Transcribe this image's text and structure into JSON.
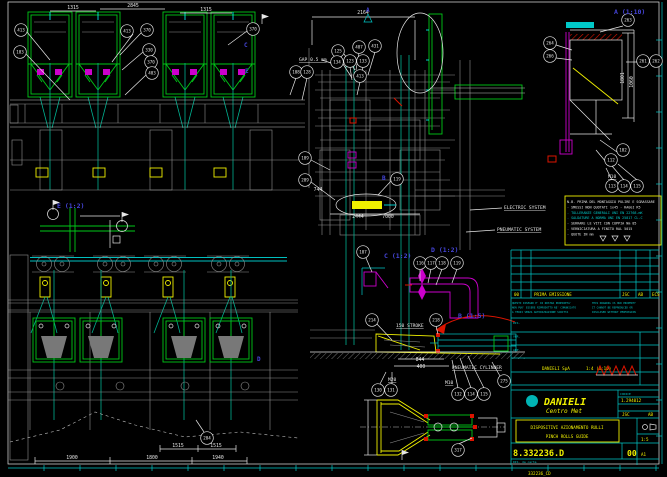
{
  "sheet": {
    "background": "#000000",
    "border_color": "#e6e6e6",
    "tick_color": "#00c8c8",
    "accent_green": "#00c818",
    "accent_cyan": "#00c8c8",
    "accent_magenta": "#cc00cc",
    "accent_yellow": "#f0f000",
    "accent_red": "#dc1400",
    "label_blue": "#4646dc"
  },
  "view_labels": [
    {
      "t": "A  (1:10)",
      "x": 614,
      "y": 14
    },
    {
      "t": "E  (1:2)",
      "x": 57,
      "y": 208
    },
    {
      "t": "C  (1:2)",
      "x": 384,
      "y": 258
    },
    {
      "t": "D  (1:2)",
      "x": 431,
      "y": 252
    },
    {
      "t": "B  (1:5)",
      "x": 458,
      "y": 318
    }
  ],
  "section_letters": [
    {
      "t": "A",
      "x": 366,
      "y": 12
    },
    {
      "t": "C",
      "x": 244,
      "y": 47
    },
    {
      "t": "E",
      "x": 245,
      "y": 73
    },
    {
      "t": "B",
      "x": 382,
      "y": 180
    },
    {
      "t": "D",
      "x": 257,
      "y": 361
    }
  ],
  "texts": [
    {
      "t": "GAP 0.5 mm",
      "x": 299,
      "y": 61,
      "u": true
    },
    {
      "t": "ELECTRIC SYSTEM",
      "x": 504,
      "y": 209,
      "u": true
    },
    {
      "t": "PNEUMATIC SYSTEM",
      "x": 497,
      "y": 231,
      "u": true
    },
    {
      "t": "PNEUMATIC CYLINDER",
      "x": 452,
      "y": 369,
      "u": true
    },
    {
      "t": "150 STROKE",
      "x": 396,
      "y": 327,
      "u": true
    },
    {
      "t": "M20",
      "x": 388,
      "y": 381,
      "u": true
    },
    {
      "t": "M10",
      "x": 445,
      "y": 384,
      "u": true
    },
    {
      "t": "M10",
      "x": 608,
      "y": 178,
      "u": true
    }
  ],
  "dims": [
    {
      "t": "1315",
      "x": 73,
      "y": 9
    },
    {
      "t": "2845",
      "x": 133,
      "y": 7
    },
    {
      "t": "1315",
      "x": 206,
      "y": 11
    },
    {
      "t": "2164",
      "x": 363,
      "y": 14
    },
    {
      "t": "1801",
      "x": 624,
      "y": 78,
      "r": -90
    },
    {
      "t": "1060",
      "x": 633,
      "y": 82,
      "r": -90
    },
    {
      "t": "744",
      "x": 318,
      "y": 191
    },
    {
      "t": "2444",
      "x": 358,
      "y": 218
    },
    {
      "t": "7000",
      "x": 388,
      "y": 218
    },
    {
      "t": "844",
      "x": 420,
      "y": 361
    },
    {
      "t": "400",
      "x": 421,
      "y": 368
    },
    {
      "t": "1515",
      "x": 178,
      "y": 447
    },
    {
      "t": "1515",
      "x": 216,
      "y": 447
    },
    {
      "t": "1900",
      "x": 72,
      "y": 459
    },
    {
      "t": "1800",
      "x": 152,
      "y": 459
    },
    {
      "t": "1940",
      "x": 218,
      "y": 459
    }
  ],
  "balloons": [
    {
      "n": "413",
      "x": 21,
      "y": 30
    },
    {
      "n": "103",
      "x": 20,
      "y": 52
    },
    {
      "n": "413",
      "x": 127,
      "y": 31
    },
    {
      "n": "370",
      "x": 147,
      "y": 30
    },
    {
      "n": "330",
      "x": 149,
      "y": 50
    },
    {
      "n": "370",
      "x": 151,
      "y": 62
    },
    {
      "n": "403",
      "x": 152,
      "y": 73
    },
    {
      "n": "370",
      "x": 253,
      "y": 29
    },
    {
      "n": "108",
      "x": 296,
      "y": 72
    },
    {
      "n": "128",
      "x": 307,
      "y": 72
    },
    {
      "n": "125",
      "x": 338,
      "y": 51
    },
    {
      "n": "134",
      "x": 337,
      "y": 62
    },
    {
      "n": "407",
      "x": 359,
      "y": 47
    },
    {
      "n": "431",
      "x": 375,
      "y": 46
    },
    {
      "n": "123",
      "x": 350,
      "y": 61
    },
    {
      "n": "133",
      "x": 363,
      "y": 61
    },
    {
      "n": "413",
      "x": 360,
      "y": 76
    },
    {
      "n": "109",
      "x": 305,
      "y": 158
    },
    {
      "n": "209",
      "x": 305,
      "y": 180
    },
    {
      "n": "119",
      "x": 397,
      "y": 179
    },
    {
      "n": "263",
      "x": 628,
      "y": 20
    },
    {
      "n": "264",
      "x": 550,
      "y": 43
    },
    {
      "n": "266",
      "x": 550,
      "y": 56
    },
    {
      "n": "261",
      "x": 643,
      "y": 61
    },
    {
      "n": "262",
      "x": 656,
      "y": 61
    },
    {
      "n": "102",
      "x": 623,
      "y": 150
    },
    {
      "n": "112",
      "x": 611,
      "y": 160
    },
    {
      "n": "113",
      "x": 612,
      "y": 186
    },
    {
      "n": "114",
      "x": 624,
      "y": 186
    },
    {
      "n": "115",
      "x": 637,
      "y": 186
    },
    {
      "n": "107",
      "x": 363,
      "y": 252
    },
    {
      "n": "116",
      "x": 420,
      "y": 263
    },
    {
      "n": "117",
      "x": 431,
      "y": 263
    },
    {
      "n": "118",
      "x": 442,
      "y": 263
    },
    {
      "n": "119",
      "x": 457,
      "y": 263
    },
    {
      "n": "214",
      "x": 372,
      "y": 320
    },
    {
      "n": "218",
      "x": 436,
      "y": 320
    },
    {
      "n": "130",
      "x": 378,
      "y": 390
    },
    {
      "n": "131",
      "x": 391,
      "y": 390
    },
    {
      "n": "132",
      "x": 458,
      "y": 394
    },
    {
      "n": "114",
      "x": 471,
      "y": 394
    },
    {
      "n": "115",
      "x": 484,
      "y": 394
    },
    {
      "n": "275",
      "x": 504,
      "y": 381
    },
    {
      "n": "317",
      "x": 458,
      "y": 450
    },
    {
      "n": "204",
      "x": 207,
      "y": 438
    }
  ],
  "notes": {
    "lines": [
      {
        "t": "N.B. PRIMA DEL MONTAGGIO PULIRE E SGRASSARE",
        "c": "#e6e6e6"
      },
      {
        "t": "- SMUSSI NON QUOTATI 1x45 - RAGGI R5",
        "c": "#e6e6e6"
      },
      {
        "t": "- TOLLERANZE GENERALI UNI EN 22768-mK",
        "c": "#00c8c8"
      },
      {
        "t": "- SALDATURE A NORMA UNI EN 25817 CL.C",
        "c": "#00c8c8"
      },
      {
        "t": "- SERRARE LE VITI CON COPPIA Nm 85",
        "c": "#e6e6e6"
      },
      {
        "t": "- VERNICIATURA A FINITO RAL 5015",
        "c": "#e6e6e6"
      },
      {
        "t": "- QUOTE IN mm",
        "c": "#e6e6e6"
      }
    ]
  },
  "revision_table": {
    "rev_row": {
      "rev": "00",
      "description": "PRIMA EMISSIONE",
      "by": "JSC",
      "chk": "AB",
      "app": "ECS"
    },
    "left_labels": [
      "DIS.",
      "VER.",
      "APP."
    ],
    "company_cell": "DANIELI SpA",
    "scale_cell": "1:4 (1:10)",
    "disclaimer_it": [
      "QUESTO DISEGNO E' DI NOSTRA PROPRIETA'",
      "NON PUO' ESSERE RIPRODOTTO NE' COMUNICATO",
      "A TERZI SENZA AUTORIZZAZIONE SCRITTA"
    ],
    "disclaimer_en": [
      "THIS DRAWING IS OUR PROPERTY",
      "IT CANNOT BE REPRODUCED OR",
      "DISCLOSED WITHOUT PERMISSION"
    ]
  },
  "title_block": {
    "company": "DANIELI",
    "division": "Centro Met",
    "ref_label": "CODICE",
    "ref_number": "1.294012",
    "sig1": "JSC",
    "sig2": "AB",
    "title_line1": "DISPOSITIVI AZIONAMENTO RULLI",
    "title_line2": "PINCH ROLLS GUIDE",
    "drawing_number": "8.332236.D",
    "revision": "00",
    "scale": "1:5",
    "format": "A1",
    "footer_code": "332236_CD"
  }
}
